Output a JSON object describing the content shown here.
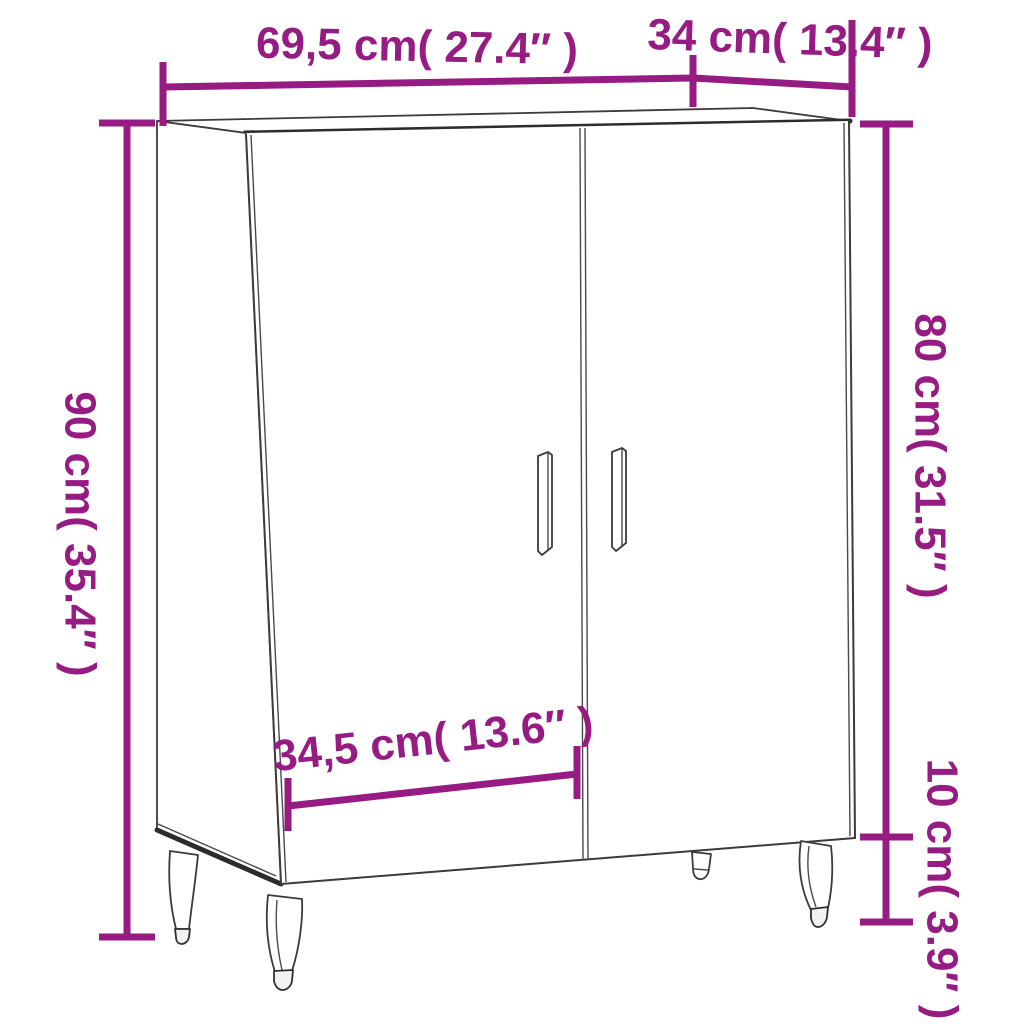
{
  "page": {
    "background": "#ffffff",
    "kind": "product-dimension-diagram",
    "product": "sideboard cabinet with two doors and metal legs"
  },
  "diagram": {
    "accent_color": "#961B82",
    "outline_color": "#3b3b3b",
    "dimensions": {
      "overall_width": {
        "cm": "69,5",
        "inch": "27.4",
        "label": "69,5 cm( 27.4″ )"
      },
      "depth": {
        "cm": "34",
        "inch": "13.4",
        "label": "34 cm( 13.4″ )"
      },
      "overall_height": {
        "cm": "90",
        "inch": "35.4",
        "label": "90 cm( 35.4″ )"
      },
      "body_height": {
        "cm": "80",
        "inch": "31.5",
        "label": "80 cm( 31.5″ )"
      },
      "door_width": {
        "cm": "34,5",
        "inch": "13.6",
        "label": "34,5 cm( 13.6″ )"
      },
      "leg_height": {
        "cm": "10",
        "inch": "3.9",
        "label": "10 cm( 3.9″ )"
      }
    }
  }
}
